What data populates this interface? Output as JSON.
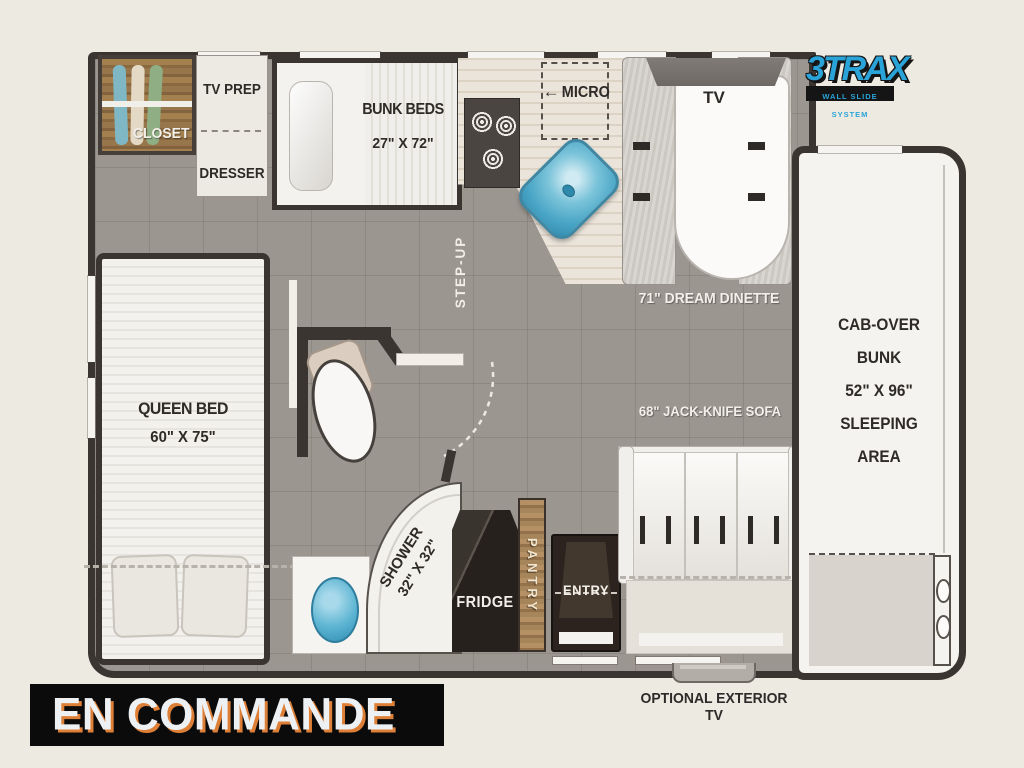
{
  "banner": {
    "label": "EN COMMANDE"
  },
  "logo": {
    "title": "3TRAX",
    "subtitle": "WALL SLIDE SYSTEM"
  },
  "rooms": {
    "closet": "CLOSET",
    "tv_prep": "TV PREP",
    "dresser": "DRESSER",
    "bunk_beds": {
      "name": "BUNK BEDS",
      "size": "27\" X 72\""
    },
    "micro": {
      "arrow": "←",
      "name": "MICRO"
    },
    "step_up": "STEP-UP",
    "tv": "TV",
    "dinette": "71\" DREAM DINETTE",
    "queen_bed": {
      "name": "QUEEN BED",
      "size": "60\" X 75\""
    },
    "cab_over_bunk": {
      "lines": [
        "CAB-OVER",
        "BUNK",
        "52\" X 96\"",
        "SLEEPING",
        "AREA"
      ]
    },
    "sofa": "68\" JACK-KNIFE SOFA",
    "shower": {
      "name": "SHOWER",
      "size": "32\" X 32\""
    },
    "fridge": "FRIDGE",
    "pantry": "PANTRY",
    "entry": "ENTRY",
    "exterior_tv": "OPTIONAL EXTERIOR TV"
  },
  "colors": {
    "background": "#edeae1",
    "floor_gray": "#9c9690",
    "wall_dark": "#3b3531",
    "sink_blue": "#45a9cf",
    "logo_blue": "#2aa4d8",
    "banner_shadow_orange": "#dd7f36",
    "closet_wood": "#9c7b52"
  }
}
